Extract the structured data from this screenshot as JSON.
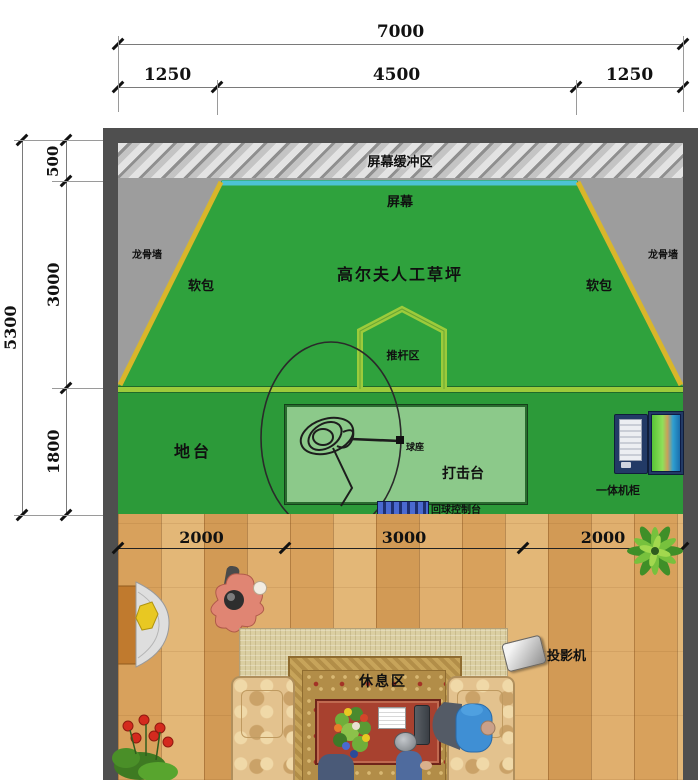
{
  "title": "高尔夫模拟室平面图",
  "dimensions": {
    "top": {
      "total": "7000",
      "segments": [
        "1250",
        "4500",
        "1250"
      ]
    },
    "left": {
      "total": "5300",
      "segments": [
        "500",
        "3000",
        "1800"
      ]
    },
    "floor": {
      "segments": [
        "2000",
        "3000",
        "2000"
      ]
    }
  },
  "zones": {
    "screen_buffer": "屏幕缓冲区",
    "screen": "屏幕",
    "keel_wall": "龙骨墙",
    "soft_pack": "软包",
    "turf": "高尔夫人工草坪",
    "putting_zone": "推杆区",
    "platform": "地台",
    "hitting_platform": "打击台",
    "tee": "球座",
    "ball_return_console": "回球控制台",
    "all_in_one_cabinet": "一体机柜",
    "rest_area": "休息区",
    "projector": "投影机"
  },
  "colors": {
    "wall": "#4f4f4f",
    "corner_gray": "#9d9d9d",
    "turf_green": "#2fa23d",
    "platform_green": "#2c9a39",
    "hitting_green": "#8cc98a",
    "edge_yellow": "#d9b62a",
    "screen_cyan": "#4cc3d4",
    "putting_outline": "#9ccb3b",
    "wood": "#dcab6b",
    "rug": "#dbcfa2",
    "table_red": "#a8412f",
    "console_blue": "#1e3070",
    "cabinet_navy": "#223a66"
  }
}
